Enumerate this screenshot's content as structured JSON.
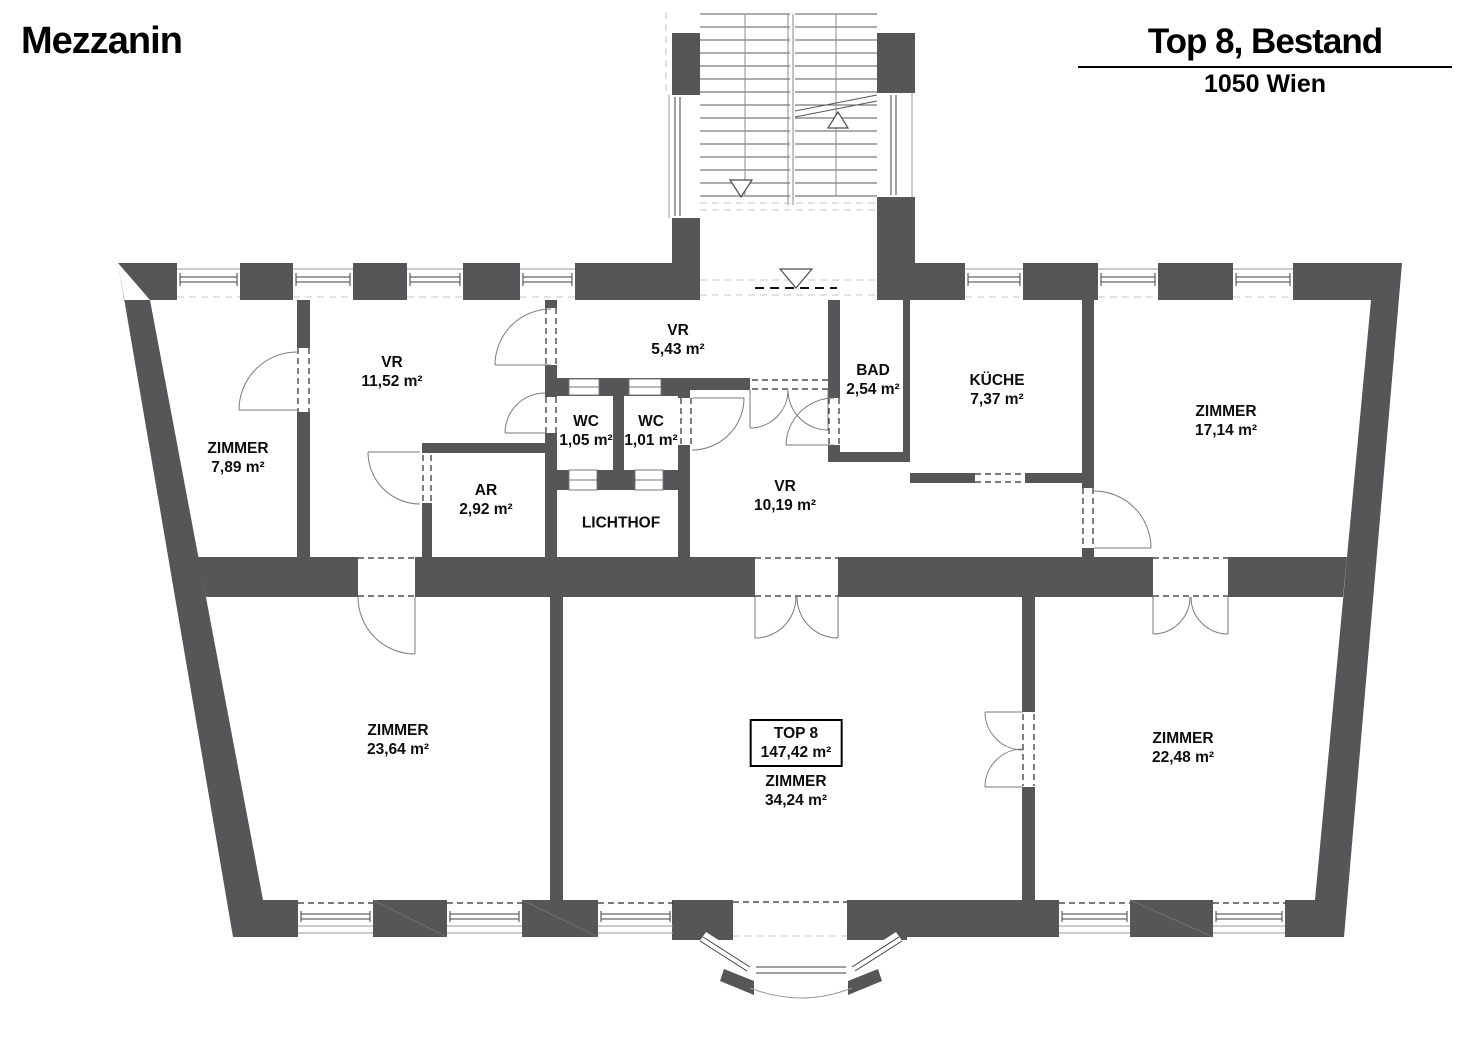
{
  "header": {
    "floor_label": "Mezzanin",
    "unit_title": "Top 8, Bestand",
    "city": "1050 Wien"
  },
  "unit_summary": {
    "name": "TOP 8",
    "area": "147,42 m²"
  },
  "colors": {
    "wall": "#565658",
    "paper": "#ffffff",
    "door_line": "#7a7a7a"
  },
  "rooms": [
    {
      "name": "ZIMMER",
      "area": "7,89 m²"
    },
    {
      "name": "VR",
      "area": "11,52 m²"
    },
    {
      "name": "VR",
      "area": "5,43 m²"
    },
    {
      "name": "WC",
      "area": "1,05 m²"
    },
    {
      "name": "WC",
      "area": "1,01 m²"
    },
    {
      "name": "AR",
      "area": "2,92 m²"
    },
    {
      "name": "LICHTHOF",
      "area": ""
    },
    {
      "name": "VR",
      "area": "10,19 m²"
    },
    {
      "name": "BAD",
      "area": "2,54 m²"
    },
    {
      "name": "KÜCHE",
      "area": "7,37 m²"
    },
    {
      "name": "ZIMMER",
      "area": "17,14 m²"
    },
    {
      "name": "ZIMMER",
      "area": "23,64 m²"
    },
    {
      "name": "ZIMMER",
      "area": "34,24 m²"
    },
    {
      "name": "ZIMMER",
      "area": "22,48 m²"
    }
  ]
}
